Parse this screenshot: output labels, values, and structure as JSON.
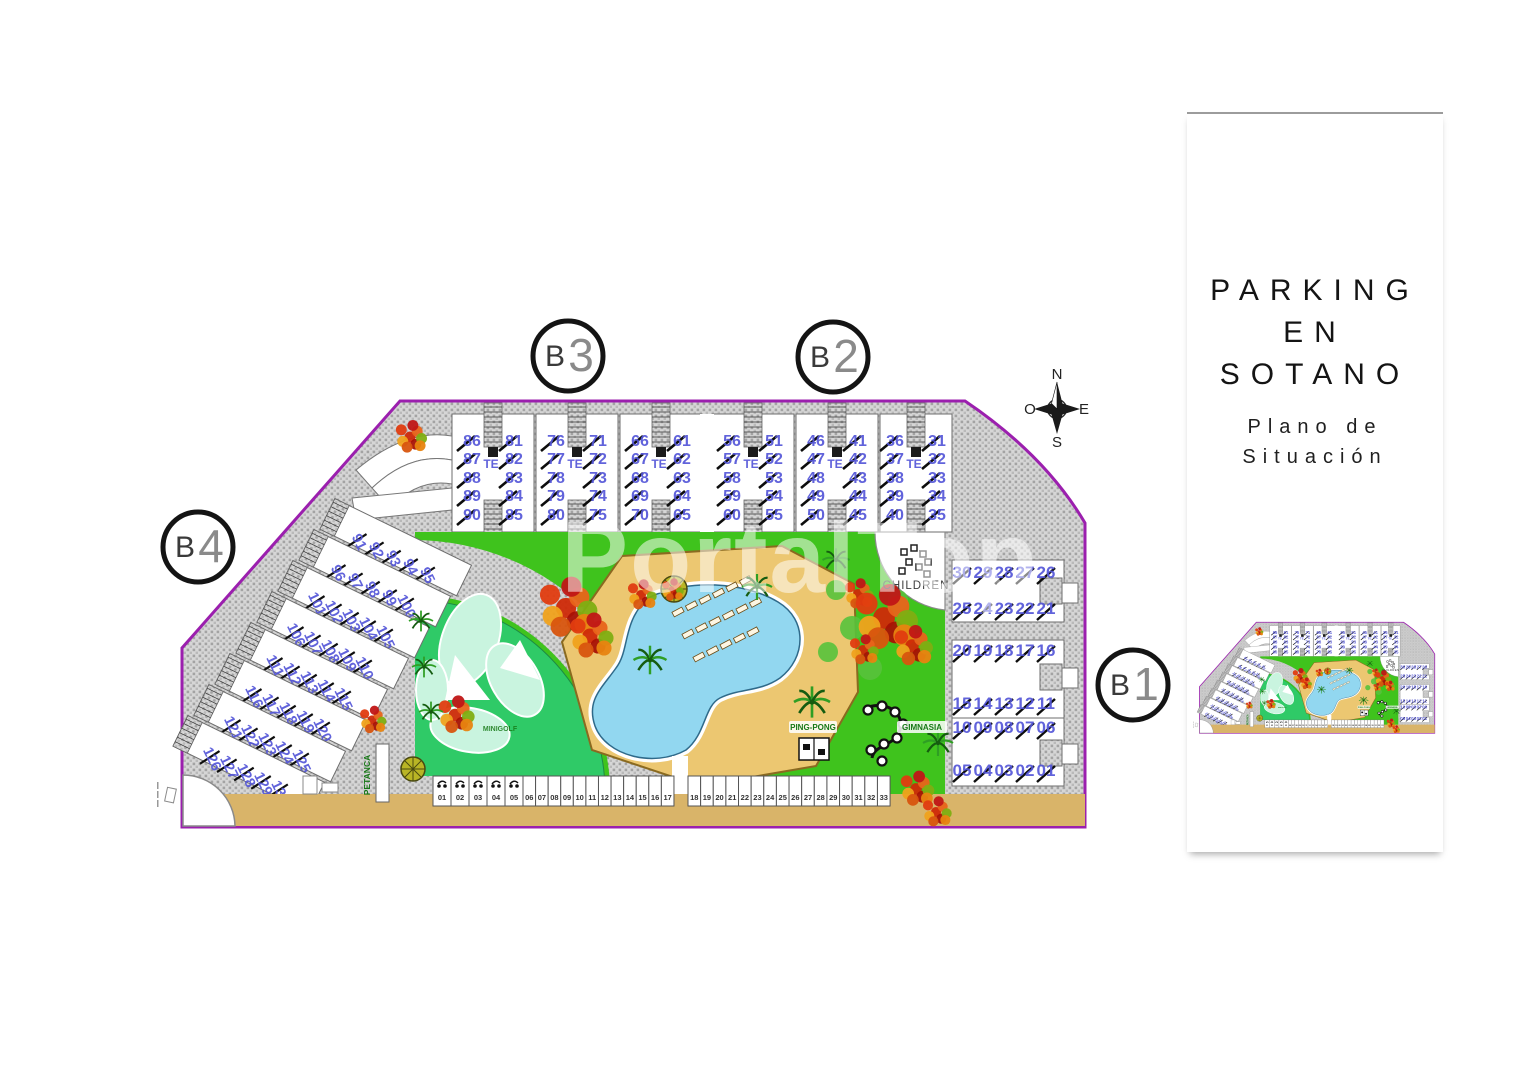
{
  "watermark": "PortalTop",
  "panel": {
    "title_line1": "PARKING",
    "title_line2": "EN SOTANO",
    "subtitle_line1": "Plano de",
    "subtitle_line2": "Situación"
  },
  "compass": {
    "north": "N",
    "south": "S",
    "east": "E",
    "west": "O"
  },
  "blocks": {
    "b1": {
      "label_prefix": "B",
      "label_number": "1",
      "rows": [
        [
          "30",
          "29",
          "28",
          "27",
          "26"
        ],
        [
          "25",
          "24",
          "23",
          "22",
          "21"
        ],
        [
          "20",
          "19",
          "18",
          "17",
          "16"
        ],
        [
          "15",
          "14",
          "13",
          "12",
          "11"
        ],
        [
          "10",
          "09",
          "08",
          "07",
          "06"
        ],
        [
          "05",
          "04",
          "03",
          "02",
          "01"
        ]
      ]
    },
    "b2": {
      "label_prefix": "B",
      "label_number": "2",
      "buildings": [
        {
          "left": [
            "56",
            "57",
            "58",
            "59",
            "60"
          ],
          "right": [
            "51",
            "52",
            "53",
            "54",
            "55"
          ],
          "core": "TE"
        },
        {
          "left": [
            "46",
            "47",
            "48",
            "49",
            "50"
          ],
          "right": [
            "41",
            "42",
            "43",
            "44",
            "45"
          ],
          "core": "TE"
        },
        {
          "left": [
            "36",
            "37",
            "38",
            "39",
            "40"
          ],
          "right": [
            "31",
            "32",
            "33",
            "34",
            "35"
          ],
          "core": "TE"
        }
      ]
    },
    "b3": {
      "label_prefix": "B",
      "label_number": "3",
      "buildings": [
        {
          "left": [
            "86",
            "87",
            "88",
            "89",
            "90"
          ],
          "right": [
            "81",
            "82",
            "83",
            "84",
            "85"
          ],
          "core": "TE"
        },
        {
          "left": [
            "76",
            "77",
            "78",
            "79",
            "80"
          ],
          "right": [
            "71",
            "72",
            "73",
            "74",
            "75"
          ],
          "core": "TE"
        },
        {
          "left": [
            "66",
            "67",
            "68",
            "69",
            "70"
          ],
          "right": [
            "61",
            "62",
            "63",
            "64",
            "65"
          ],
          "core": "TE"
        }
      ]
    },
    "b4": {
      "label_prefix": "B",
      "label_number": "4",
      "rows": [
        [
          "91",
          "92",
          "93",
          "94",
          "95"
        ],
        [
          "96",
          "97",
          "98",
          "99",
          "100"
        ],
        [
          "101",
          "102",
          "103",
          "104",
          "105"
        ],
        [
          "106",
          "107",
          "108",
          "109",
          "110"
        ],
        [
          "111",
          "112",
          "113",
          "114",
          "115"
        ],
        [
          "116",
          "117",
          "118",
          "119",
          "120"
        ],
        [
          "121",
          "122",
          "123",
          "124",
          "125"
        ],
        [
          "126",
          "127",
          "128",
          "129",
          "130"
        ]
      ]
    }
  },
  "amenities": {
    "children": "CHILDREN",
    "ping_pong": "PING-PONG",
    "gimnasia": "GIMNASIA",
    "petanca": "PETANCA",
    "minigolf": "MINIGOLF"
  },
  "parking": {
    "group1": [
      "01",
      "02",
      "03",
      "04",
      "05",
      "06",
      "07",
      "08",
      "09",
      "10",
      "11",
      "12",
      "13",
      "14",
      "15",
      "16",
      "17"
    ],
    "group2": [
      "18",
      "19",
      "20",
      "21",
      "22",
      "23",
      "24",
      "25",
      "26",
      "27",
      "28",
      "29",
      "30",
      "31",
      "32",
      "33"
    ],
    "moto_space_count": 5
  },
  "colors": {
    "boundary": "#9b1fae",
    "garden": "#3fc31d",
    "minigolf_green": "#2fca67",
    "minigolf_pale": "#c9f4df",
    "pool": "#92d7f0",
    "sand": "#ecc771",
    "road": "#d9b469",
    "unit_number": "#5456d8",
    "amenity_label": "#167816"
  }
}
